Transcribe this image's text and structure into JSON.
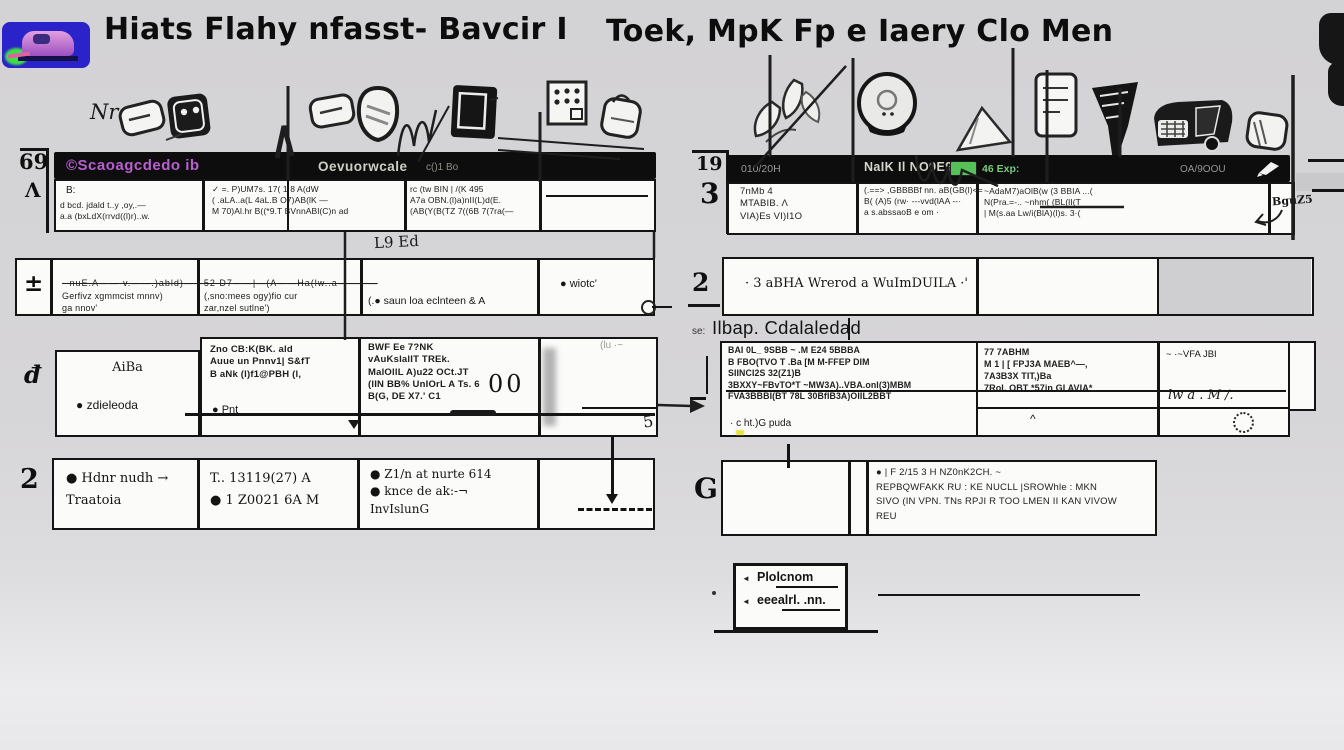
{
  "colors": {
    "bar_black": "#0d0d0d",
    "accent_purple": "#b95fd2",
    "battery_green": "#56c158",
    "battery_text_green": "#79c97b",
    "logo_blue": "#2a23c9",
    "logo_green": "#3ede49",
    "logo_car_purple": "#c77bd8"
  },
  "icons": {
    "left_strip": [
      "card-icon",
      "plug-icon",
      "note-card-icon",
      "shield-icon",
      "monitor-icon",
      "dot-grid-icon",
      "bag-icon"
    ],
    "right_strip": [
      "leaf-icon",
      "can-icon",
      "cone-icon",
      "note-icon",
      "funnel-icon",
      "truck-icon",
      "pouch-icon"
    ],
    "bar": [
      "pen-icon"
    ]
  },
  "header": {
    "left_title": "Hiats Flahy nfasst- Bavcir I",
    "right_title": "Toek, MpK Fp e  Iaery Clo Men"
  },
  "left_panel": {
    "corner_num": "69",
    "corner_sym": "Λ",
    "icons_label": "Nr",
    "bar": {
      "brand": "©Scaoagcdedo ib",
      "title": "Oevuorwcale",
      "suffix": "c()1 Bo"
    },
    "table1": {
      "c1_head": "B:",
      "c1": "d bcd. jdald t..y ,oy,.—\na.a (bxLdX(rrvd((l)r)..w.",
      "c2": "✓    =. P)UM7s. 17( 1 8 A(dW\n(    .aLA..a(L 4aL.B O7)AB(lK —\nM    70)Al.hr B((*9.T BVnnABl(C)n ad",
      "c3": "rc (tw BIN  | /(K  495\nA7a OBN.(l)a)nII(L)d(E.\n(AB(Y(B(TZ 7((6B 7(7ra(—"
    },
    "tag": "L9 Ed",
    "row2": {
      "num": "±",
      "strike": "- nuE.A——·v.——.)abld)——52  D7——|—(A——Ha(lw..a————",
      "c1": "Gerfivz xgmmcist mnnv)\nga nnov'",
      "c2": "(,sno:mees ogy)fio cur\nzar,nzel sutlne')",
      "c3": "(.● saun loa eclnteen   &   A",
      "c4": "● wiotc'"
    },
    "row3": {
      "num": "đ",
      "c1_title": "AiBa",
      "c1_bullet": "●  zdieleoda",
      "c2": "Zno CB:K(BK. ald\nAuue un Pnnv1| S&fT\nB aNk (l)f1@PBH (l,",
      "c2_bullet": "●  Pnt",
      "c3": "BWF Ee 7?NK\n vAuKslalIT TREk.\n MalOllL A)u22 OCt.JT\n(lIN BB% UnIOrL A Ts. 6\nB(G, DE X7.' C1",
      "c3_big": "00",
      "c4_note": "(lu ·~",
      "c4_corner": "5"
    },
    "row4": {
      "num": "2",
      "c1": "● Hdnr nudh →\nTraatoia",
      "c2": "T..    13119(27) A\n●   1   Z0021 6A M",
      "c3": "●  Z1/n at nurte 614\n●  knce de ak:-¬\n        InvIslunG"
    }
  },
  "right_panel": {
    "corner_num": "19",
    "corner_num2": "3",
    "bar": {
      "left": "010/20H",
      "title": "NaIK Il NO9E9%:.",
      "battery_label": "46 Exp:",
      "right": "OA/9OOU"
    },
    "table1": {
      "c1": "7nMb   4\nMTABIB.   Λ\nVIA)Es VI)I1O",
      "c2": "(.==> ,GBBBBf nn. aB(GB(l)<=\nB( (A)5 (rw· ---vvd(lAA --·\na s.abssaoB e om   ·",
      "c3": "~AdaM7)aOlB(w (3  BBIA ...(\nN(Pra.=-.. ~nhm( (BL(lI(T\n| M(s.aa Lw/i(BlA)(l)s. 3·(",
      "c4": "BguZ5"
    },
    "row2": {
      "num": "2",
      "c1": "·  3 aBHA Wrerod  a WuImDUILA  ·'"
    },
    "sub_label": {
      "prefix": "se:",
      "text": "Ilbap. Cdalaledad"
    },
    "row3": {
      "c1": "BAI 0L_ 9SBB   ~ .M E24 5BBBA\nB FBO(TVO T    .Ba [M M-FFEP DIM\nSIINCI2S 32(Z1)B\n3BXXY~FBvTO*T ~MW3A)..VBA.onl(3)MBM\nFVA3BBBI(BT 78L 30BfIB3A)OIIL2BBT",
      "c1_bottom": "· c ht.)G puda",
      "c2": "77 7ABHM\nM 1 | [ FPJ3A    MAEB^—,\n7A3B3X TIT,)Ba\n7RoI. OBT *57in GI AVIA*",
      "c2_caret": "^",
      "c3_top": "~  ·~VFA JBI",
      "c3_hand": "lw   a .   M /."
    },
    "row4": {
      "num": "G",
      "c2": "●   | F 2/15 3 H NZ0nK2CH.   ~\nREPBQWFAKK  RU : KE NUCLL |SROWhle : MKN\nSIVO (IN VPN.  TNs RPJI R TOO LMEN II KAN VIVOW\nREU"
    },
    "legend": {
      "bullet": "◄",
      "item1": "Plolcnom",
      "item2": "eeealrl. .nn."
    }
  }
}
